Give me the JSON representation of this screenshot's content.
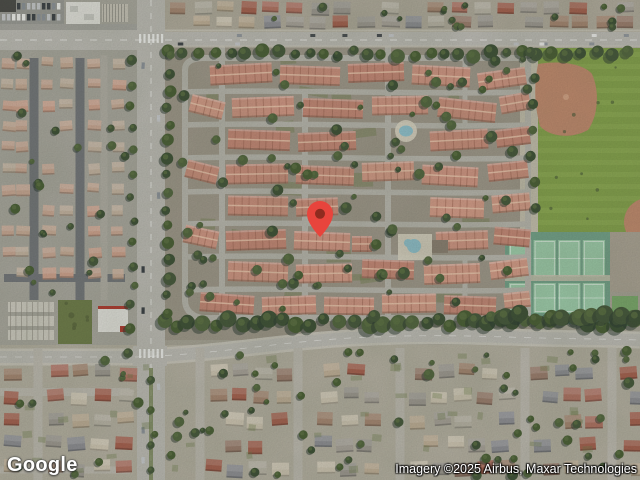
{
  "map": {
    "view_type": "satellite",
    "marker": {
      "icon": "red-location-pin",
      "outer_color": "#E8443C",
      "inner_color": "#8F2B1F",
      "tip_x": 320,
      "tip_y": 238
    },
    "palette": {
      "base": "#a7a396",
      "community_ground": "#9e978a",
      "street": "#b7b5ad",
      "main_road": "#bdbbb5",
      "road_edge": "#cac7bc",
      "suburb_ground": "#b4afa1",
      "left_ground": "#a9a79e",
      "asphalt_dark": "#73767a",
      "roof_salmon": [
        "#c98e7c",
        "#cf9583",
        "#c48776",
        "#d49b88"
      ],
      "roof_suburb": [
        "#9d9891",
        "#a8a29a",
        "#b07263",
        "#bfae97",
        "#8e8e94",
        "#a58672",
        "#b8b3a6",
        "#9b7d6e",
        "#a5604f",
        "#cdc4b2"
      ],
      "roof_left": [
        "#c8ab97",
        "#cfa28e",
        "#c3b2a0",
        "#c9a794"
      ],
      "tree_greens": [
        "#45573b",
        "#3d5036",
        "#52653f",
        "#495e35"
      ],
      "tree_shadow": "#2b3a31",
      "tree_light": "#5d7244",
      "park_grass": "#84a14c",
      "park_grass_light": "#98b55e",
      "infield_dirt": "#c18a6e",
      "tennis_apron": "#73a189",
      "tennis_court": "#9dcbaa",
      "walkway": "#c3bead",
      "pool_water": "#8fc0cc",
      "pool_deck": "#d8d3c2",
      "white_building": "#e4e3de",
      "lane_marking": "#ffffff",
      "garage_roof": "#cfccc2",
      "lawn_dark": "#6e7c4a"
    }
  },
  "branding": {
    "logo_text": "Google"
  },
  "attribution": {
    "imagery_credit": "Imagery ©2025 Airbus, Maxar Technologies"
  }
}
